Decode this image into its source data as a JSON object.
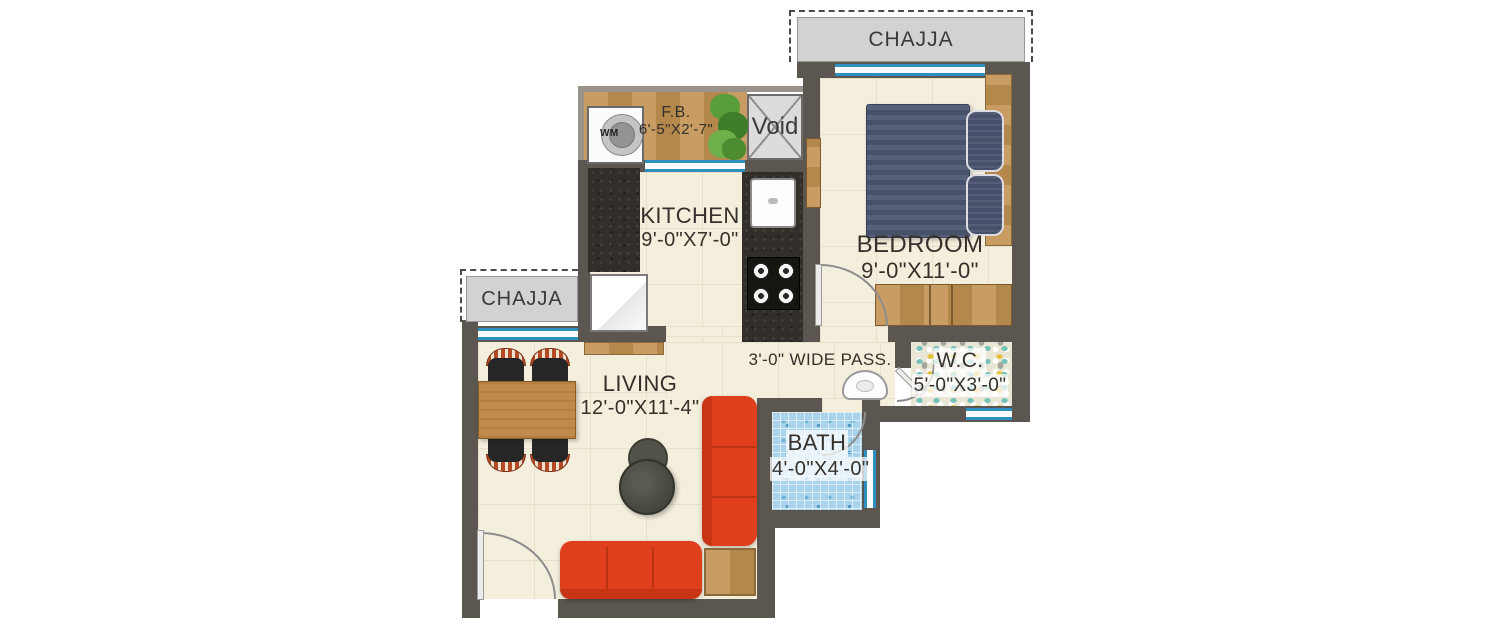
{
  "floorplan": {
    "chajja_top_label": "CHAJJA",
    "chajja_left_label": "CHAJJA",
    "void_label": "Void",
    "wm_label": "WM",
    "passage_label": "3'-0\" WIDE PASS.",
    "rooms": {
      "kitchen": {
        "name": "KITCHEN",
        "dims": "9'-0\"X7'-0\""
      },
      "bedroom": {
        "name": "BEDROOM",
        "dims": "9'-0\"X11'-0\""
      },
      "living": {
        "name": "LIVING",
        "dims": "12'-0\"X11'-4\""
      },
      "bath": {
        "name": "BATH",
        "dims": "4'-0\"X4'-0\""
      },
      "wc": {
        "name": "W.C.",
        "dims": "5'-0\"X3'-0\""
      },
      "flower_bed": {
        "name": "F.B.",
        "dims": "6'-5\"X2'-7\""
      }
    },
    "colors": {
      "wall": "#5c5650",
      "floor": "#f4eedd",
      "sofa_red": "#df3f1d",
      "bed_navy": "#4e5870",
      "wood": "#c09058",
      "bath_tile": "#a9d3ea",
      "window_blue": "#2e8fc0",
      "chajja_gray": "#d2d2d2"
    }
  }
}
